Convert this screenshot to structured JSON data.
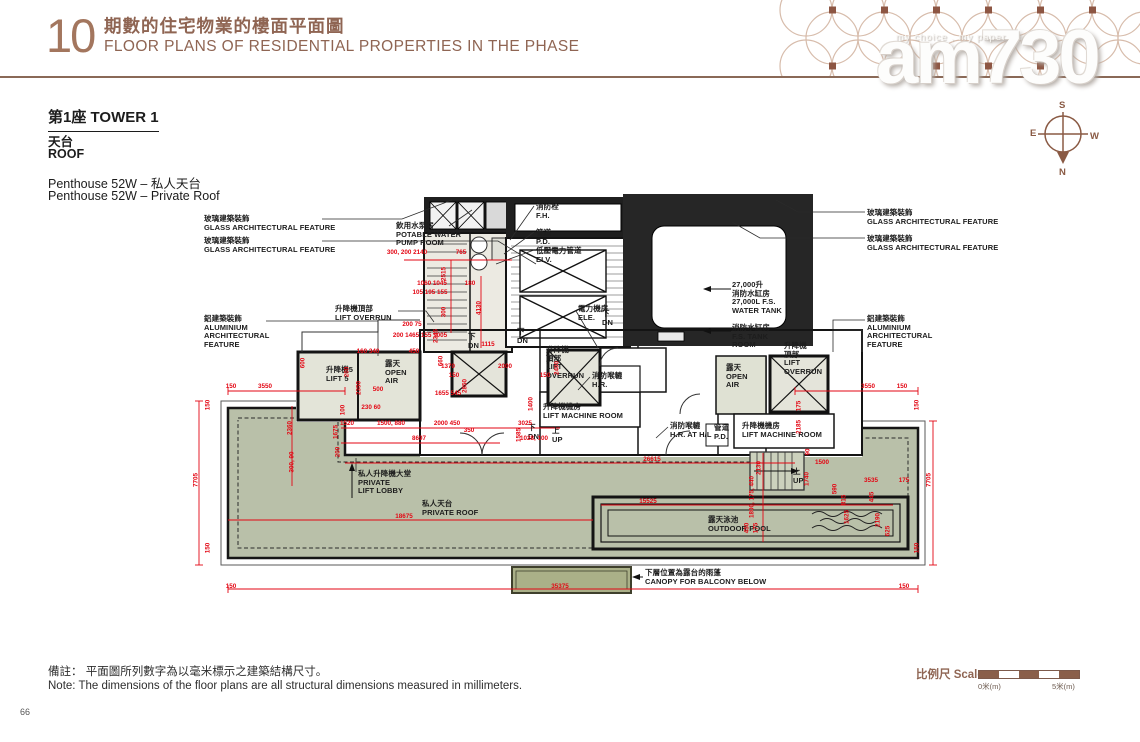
{
  "page": {
    "number": "66"
  },
  "header": {
    "section_no": "10",
    "title_zh": "期數的住宅物業的樓面平面圖",
    "title_en": "FLOOR PLANS OF RESIDENTIAL PROPERTIES IN THE PHASE"
  },
  "watermark": {
    "brand": "am730",
    "tagline": "my choice , my paper"
  },
  "compass": {
    "top": "S",
    "left": "E",
    "right": "W",
    "bottom": "N"
  },
  "title_block": {
    "tower": "第1座 TOWER 1",
    "floor_zh": "天台",
    "floor_en": "ROOF",
    "unit_zh": "Penthouse 52W – 私人天台",
    "unit_en": "Penthouse 52W – Private Roof"
  },
  "notes": {
    "zh": "備註： 平面圖所列數字為以毫米標示之建築結構尺寸。",
    "en": "Note:  The dimensions of the floor plans are all structural dimensions measured in millimeters."
  },
  "scale_bar": {
    "label_zh": "比例尺",
    "label_en": "Scale",
    "min": "0米(m)",
    "max": "5米(m)"
  },
  "colors": {
    "accent_brown": "#8f6553",
    "dim_red": "#e30613",
    "roof_green": "#b9c0a9",
    "canopy_olive": "#aab088"
  },
  "plan": {
    "labels": [
      {
        "lines": [
          "玻璃建築裝飾",
          "GLASS ARCHITECTURAL FEATURE"
        ],
        "x": 204,
        "y": 215
      },
      {
        "lines": [
          "玻璃建築裝飾",
          "GLASS ARCHITECTURAL FEATURE"
        ],
        "x": 204,
        "y": 237
      },
      {
        "lines": [
          "飲用水泵房",
          "POTABLE WATER",
          "PUMP ROOM"
        ],
        "x": 396,
        "y": 222
      },
      {
        "lines": [
          "升降機頂部",
          "LIFT  OVERRUN"
        ],
        "x": 335,
        "y": 305
      },
      {
        "lines": [
          "鋁建築裝飾",
          "ALUMINIUM",
          "ARCHITECTURAL",
          "FEATURE"
        ],
        "x": 204,
        "y": 315
      },
      {
        "lines": [
          "消防栓",
          "F.H."
        ],
        "x": 536,
        "y": 203
      },
      {
        "lines": [
          "管道",
          "P.D."
        ],
        "x": 536,
        "y": 229
      },
      {
        "lines": [
          "低壓電力管道",
          "ELV."
        ],
        "x": 536,
        "y": 247
      },
      {
        "lines": [
          "玻璃建築裝飾",
          "GLASS ARCHITECTURAL FEATURE"
        ],
        "x": 867,
        "y": 209
      },
      {
        "lines": [
          "玻璃建築裝飾",
          "GLASS ARCHITECTURAL FEATURE"
        ],
        "x": 867,
        "y": 235
      },
      {
        "lines": [
          "鋁建築裝飾",
          "ALUMINIUM",
          "ARCHITECTURAL",
          "FEATURE"
        ],
        "x": 867,
        "y": 315
      },
      {
        "lines": [
          "27,000升",
          "消防水缸房",
          "27,000L F.S.",
          "WATER TANK"
        ],
        "x": 732,
        "y": 281
      },
      {
        "lines": [
          "消防水缸房",
          "F.S. TANK",
          "ROOM"
        ],
        "x": 732,
        "y": 324
      },
      {
        "lines": [
          "電力機房",
          "ELE."
        ],
        "x": 578,
        "y": 305
      },
      {
        "lines": [
          "升降機",
          "頂部",
          "LIFT",
          "OVERRUN"
        ],
        "x": 546,
        "y": 346
      },
      {
        "lines": [
          "消防喉轆",
          "H.R."
        ],
        "x": 592,
        "y": 372
      },
      {
        "lines": [
          "升降機機房",
          "LIFT MACHINE ROOM"
        ],
        "x": 543,
        "y": 403
      },
      {
        "lines": [
          "升降機5",
          "LIFT 5"
        ],
        "x": 326,
        "y": 366
      },
      {
        "lines": [
          "露天",
          "OPEN",
          "AIR"
        ],
        "x": 385,
        "y": 360
      },
      {
        "lines": [
          "露天",
          "OPEN",
          "AIR"
        ],
        "x": 726,
        "y": 364
      },
      {
        "lines": [
          "升降機",
          "頂部",
          "LIFT",
          "OVERRUN"
        ],
        "x": 784,
        "y": 342
      },
      {
        "lines": [
          "消防喉轆",
          "H.R. AT H/L"
        ],
        "x": 670,
        "y": 422
      },
      {
        "lines": [
          "管道",
          "P.D."
        ],
        "x": 714,
        "y": 424
      },
      {
        "lines": [
          "升降機機房",
          "LIFT MACHINE ROOM"
        ],
        "x": 742,
        "y": 422
      },
      {
        "lines": [
          "私人升降機大堂",
          "PRIVATE",
          "LIFT LOBBY"
        ],
        "x": 358,
        "y": 470
      },
      {
        "lines": [
          "私人天台",
          "PRIVATE ROOF"
        ],
        "x": 422,
        "y": 500
      },
      {
        "lines": [
          "露天泳池",
          "OUTDOOR POOL"
        ],
        "x": 708,
        "y": 516
      },
      {
        "lines": [
          "下層位置為露台的雨蓬",
          "CANOPY FOR BALCONY BELOW"
        ],
        "x": 645,
        "y": 569
      },
      {
        "lines": [
          "下",
          "DN"
        ],
        "x": 468,
        "y": 333
      },
      {
        "lines": [
          "下",
          "DN"
        ],
        "x": 517,
        "y": 328
      },
      {
        "lines": [
          "下",
          "DN"
        ],
        "x": 602,
        "y": 310
      },
      {
        "lines": [
          "下",
          "DN"
        ],
        "x": 528,
        "y": 424
      },
      {
        "lines": [
          "上",
          "UP"
        ],
        "x": 552,
        "y": 427
      },
      {
        "lines": [
          "上",
          "UP"
        ],
        "x": 793,
        "y": 468
      }
    ],
    "dims": [
      {
        "t": "300, 200 2140",
        "x": 407,
        "y": 253
      },
      {
        "t": "765",
        "x": 461,
        "y": 253
      },
      {
        "t": "2515",
        "x": 444,
        "y": 274,
        "v": 1
      },
      {
        "t": "300",
        "x": 444,
        "y": 312,
        "v": 1
      },
      {
        "t": "2345",
        "x": 436,
        "y": 336,
        "v": 1
      },
      {
        "t": "200 75",
        "x": 412,
        "y": 325
      },
      {
        "t": "1060 1045",
        "x": 432,
        "y": 284
      },
      {
        "t": "180",
        "x": 470,
        "y": 284
      },
      {
        "t": "105 195 155",
        "x": 430,
        "y": 293
      },
      {
        "t": "4130",
        "x": 479,
        "y": 308,
        "v": 1
      },
      {
        "t": "1115",
        "x": 488,
        "y": 345
      },
      {
        "t": "200 1465 155 1005",
        "x": 420,
        "y": 336
      },
      {
        "t": "450",
        "x": 414,
        "y": 352
      },
      {
        "t": "160 340",
        "x": 368,
        "y": 352
      },
      {
        "t": "660",
        "x": 441,
        "y": 361,
        "v": 1
      },
      {
        "t": "1370",
        "x": 448,
        "y": 367
      },
      {
        "t": "150",
        "x": 454,
        "y": 376
      },
      {
        "t": "2000",
        "x": 505,
        "y": 367
      },
      {
        "t": "150",
        "x": 545,
        "y": 376
      },
      {
        "t": "2400",
        "x": 557,
        "y": 368,
        "v": 1
      },
      {
        "t": "2850",
        "x": 465,
        "y": 386,
        "v": 1
      },
      {
        "t": "1655 545",
        "x": 448,
        "y": 394
      },
      {
        "t": "1400",
        "x": 531,
        "y": 404,
        "v": 1
      },
      {
        "t": "600",
        "x": 303,
        "y": 363,
        "v": 1
      },
      {
        "t": "2350",
        "x": 359,
        "y": 388,
        "v": 1
      },
      {
        "t": "200",
        "x": 347,
        "y": 372,
        "v": 1
      },
      {
        "t": "500",
        "x": 378,
        "y": 390
      },
      {
        "t": "230 60",
        "x": 371,
        "y": 408
      },
      {
        "t": "100",
        "x": 343,
        "y": 410,
        "v": 1
      },
      {
        "t": "1520",
        "x": 347,
        "y": 424
      },
      {
        "t": "1500, 880",
        "x": 391,
        "y": 424
      },
      {
        "t": "2000 450",
        "x": 447,
        "y": 424
      },
      {
        "t": "350",
        "x": 469,
        "y": 431
      },
      {
        "t": "3025",
        "x": 525,
        "y": 424
      },
      {
        "t": "8697",
        "x": 419,
        "y": 439
      },
      {
        "t": "1585",
        "x": 519,
        "y": 435,
        "v": 1
      },
      {
        "t": "1028, 100",
        "x": 534,
        "y": 439
      },
      {
        "t": "1675",
        "x": 336,
        "y": 432,
        "v": 1
      },
      {
        "t": "200",
        "x": 338,
        "y": 452,
        "v": 1
      },
      {
        "t": "26615",
        "x": 652,
        "y": 460
      },
      {
        "t": "18675",
        "x": 404,
        "y": 517
      },
      {
        "t": "35375",
        "x": 560,
        "y": 587
      },
      {
        "t": "150",
        "x": 231,
        "y": 587
      },
      {
        "t": "150",
        "x": 904,
        "y": 587
      },
      {
        "t": "150",
        "x": 231,
        "y": 387
      },
      {
        "t": "3550",
        "x": 265,
        "y": 387
      },
      {
        "t": "3550",
        "x": 868,
        "y": 387
      },
      {
        "t": "150",
        "x": 902,
        "y": 387
      },
      {
        "t": "150",
        "x": 208,
        "y": 405,
        "v": 1
      },
      {
        "t": "7705",
        "x": 196,
        "y": 480,
        "v": 1
      },
      {
        "t": "150",
        "x": 208,
        "y": 548,
        "v": 1
      },
      {
        "t": "2360",
        "x": 290,
        "y": 428,
        "v": 1
      },
      {
        "t": "300, 90",
        "x": 292,
        "y": 462,
        "v": 1
      },
      {
        "t": "150",
        "x": 917,
        "y": 405,
        "v": 1
      },
      {
        "t": "7705",
        "x": 929,
        "y": 480,
        "v": 1
      },
      {
        "t": "150",
        "x": 917,
        "y": 548,
        "v": 1
      },
      {
        "t": "175",
        "x": 799,
        "y": 406,
        "v": 1
      },
      {
        "t": "2185",
        "x": 799,
        "y": 427,
        "v": 1
      },
      {
        "t": "90",
        "x": 808,
        "y": 452,
        "v": 1
      },
      {
        "t": "1500",
        "x": 822,
        "y": 463
      },
      {
        "t": "1740",
        "x": 807,
        "y": 479,
        "v": 1
      },
      {
        "t": "3535",
        "x": 871,
        "y": 481
      },
      {
        "t": "175",
        "x": 904,
        "y": 481
      },
      {
        "t": "2130",
        "x": 759,
        "y": 468,
        "v": 1
      },
      {
        "t": "1800, 175, 440",
        "x": 752,
        "y": 497,
        "v": 1
      },
      {
        "t": "450",
        "x": 747,
        "y": 528,
        "v": 1
      },
      {
        "t": "175",
        "x": 756,
        "y": 528,
        "v": 1
      },
      {
        "t": "15525",
        "x": 648,
        "y": 502
      },
      {
        "t": "590",
        "x": 835,
        "y": 489,
        "v": 1
      },
      {
        "t": "815",
        "x": 844,
        "y": 500,
        "v": 1
      },
      {
        "t": "1625",
        "x": 847,
        "y": 517,
        "v": 1
      },
      {
        "t": "445",
        "x": 872,
        "y": 497,
        "v": 1
      },
      {
        "t": "2190",
        "x": 878,
        "y": 520,
        "v": 1
      },
      {
        "t": "625",
        "x": 888,
        "y": 531,
        "v": 1
      }
    ]
  }
}
